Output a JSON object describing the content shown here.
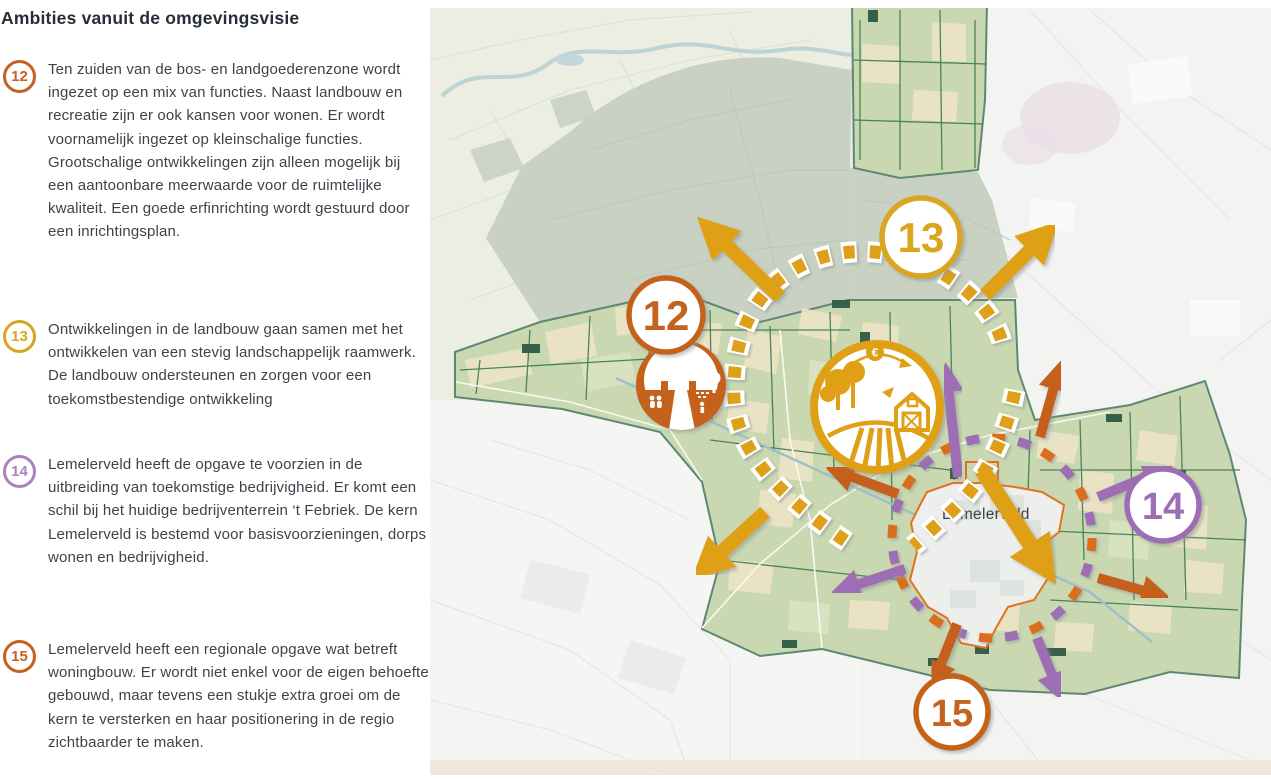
{
  "panel": {
    "title": "Ambities vanuit de omgevingsvisie",
    "items": [
      {
        "number": "12",
        "color": "#c4621f",
        "text": "Ten zuiden van de bos- en landgoederenzone wordt ingezet op een mix van functies. Naast landbouw en recreatie zijn er ook kansen voor wonen. Er wordt voornamelijk ingezet op kleinschalige functies. Grootschalige ontwikkelingen zijn alleen mogelijk bij een aantoonbare meerwaarde voor de ruimtelijke kwaliteit. Een goede erfinrichting wordt gestuurd door een inrichtingsplan."
      },
      {
        "number": "13",
        "color": "#d7a51f",
        "text": "Ontwikkelingen in de landbouw gaan samen met het ontwikkelen van een stevig landschappelijk raamwerk. De landbouw ondersteunen en zorgen voor een toekomstbestendige ontwikkeling"
      },
      {
        "number": "14",
        "color": "#a981bd",
        "text": "Lemelerveld heeft de opgave te voorzien in de uitbreiding van toekomstige bedrijvigheid. Er komt een schil bij het huidige bedrijventerrein ‘t Febriek. De kern Lemelerveld is bestemd voor basisvoorzieningen, dorps wonen en bedrijvigheid."
      },
      {
        "number": "15",
        "color": "#c4621f",
        "text": "Lemelerveld heeft een regionale opgave wat betreft woningbouw. Er wordt niet enkel voor de eigen behoefte gebouwd, maar tevens een stukje extra groei om de kern te versterken en haar positionering in de regio zichtbaarder te maken."
      }
    ]
  },
  "map": {
    "town_label": "Lemelerveld",
    "badges": [
      {
        "number": "12",
        "color": "#c4621f"
      },
      {
        "number": "13",
        "color": "#d9a620"
      },
      {
        "number": "14",
        "color": "#9d6eb4"
      },
      {
        "number": "15",
        "color": "#c4621f"
      }
    ],
    "farm_icon": {
      "euro_symbol": "€"
    },
    "icons": {
      "estate_icon": "farmstead-buildings-icon",
      "agriculture_icon": "farm-economy-icon"
    },
    "colors": {
      "gold": "#dfa019",
      "orange_arrow": "#c65f1d",
      "purple_arrow": "#9d6eb4",
      "dash_circle_orange": "#d96e1f",
      "municipality_green": "#c9d8b0",
      "forest_muted": "#c9d1c3",
      "town_outline": "#e2721f",
      "canal_blue": "#9fc0c9",
      "boundary_teal": "#5d8873"
    }
  }
}
